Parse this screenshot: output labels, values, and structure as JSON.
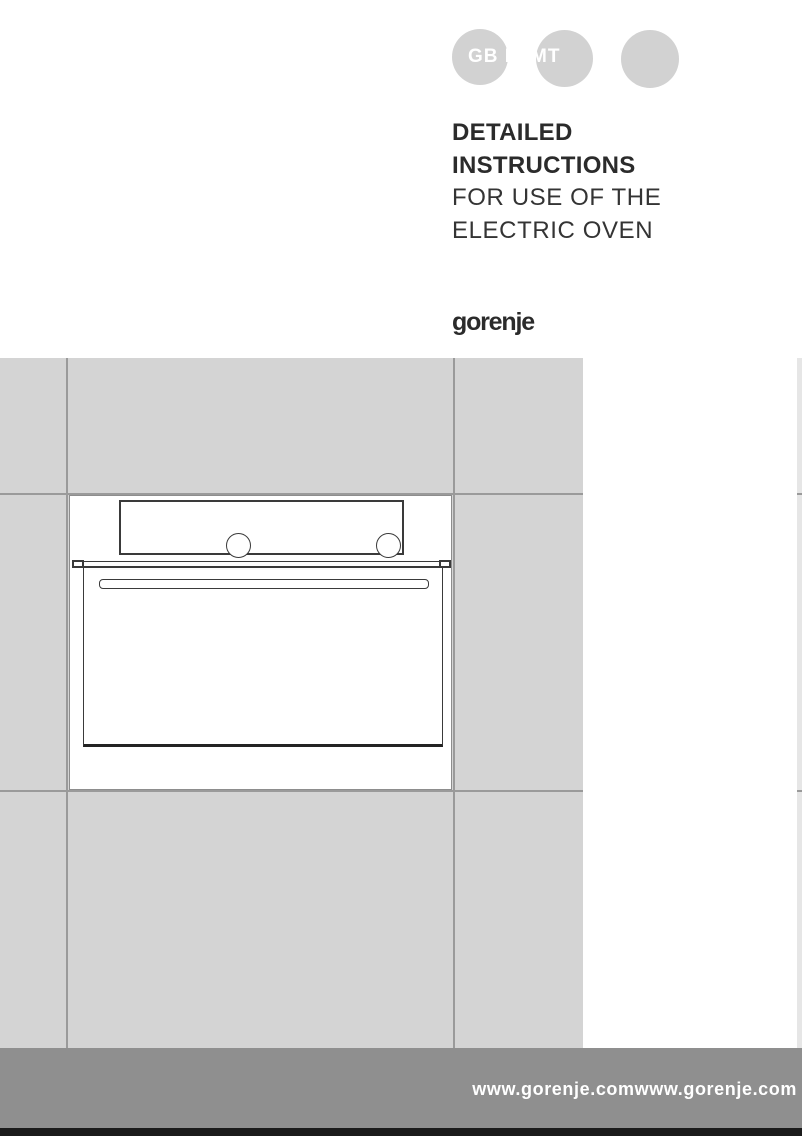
{
  "header": {
    "language_codes": "GB IE MT",
    "title_lines": [
      {
        "text": "DETAILED",
        "style": "bold"
      },
      {
        "text": "INSTRUCTIONS",
        "style": "bold"
      },
      {
        "text": "FOR USE OF THE",
        "style": "light"
      },
      {
        "text": "ELECTRIC OVEN",
        "style": "light"
      }
    ],
    "brand_logo": "gorenje"
  },
  "illustration": {
    "name": "built-in-electric-oven-line-drawing-on-tiled-wall"
  },
  "footer": {
    "website_text": "www.gorenje.comwww.gorenje.com"
  },
  "colors": {
    "tile": "#d4d4d4",
    "tile_edge": "#e6e6e6",
    "grout": "#9a9a9a",
    "badge_circle": "#d2d2d2",
    "badge_text": "#ffffff",
    "title_text": "#2b2b2b",
    "drawing_line": "#3a3a3a",
    "footer_band": "#8f8f8f",
    "footer_text": "#ffffff",
    "footer_bar": "#1b1b1b"
  }
}
